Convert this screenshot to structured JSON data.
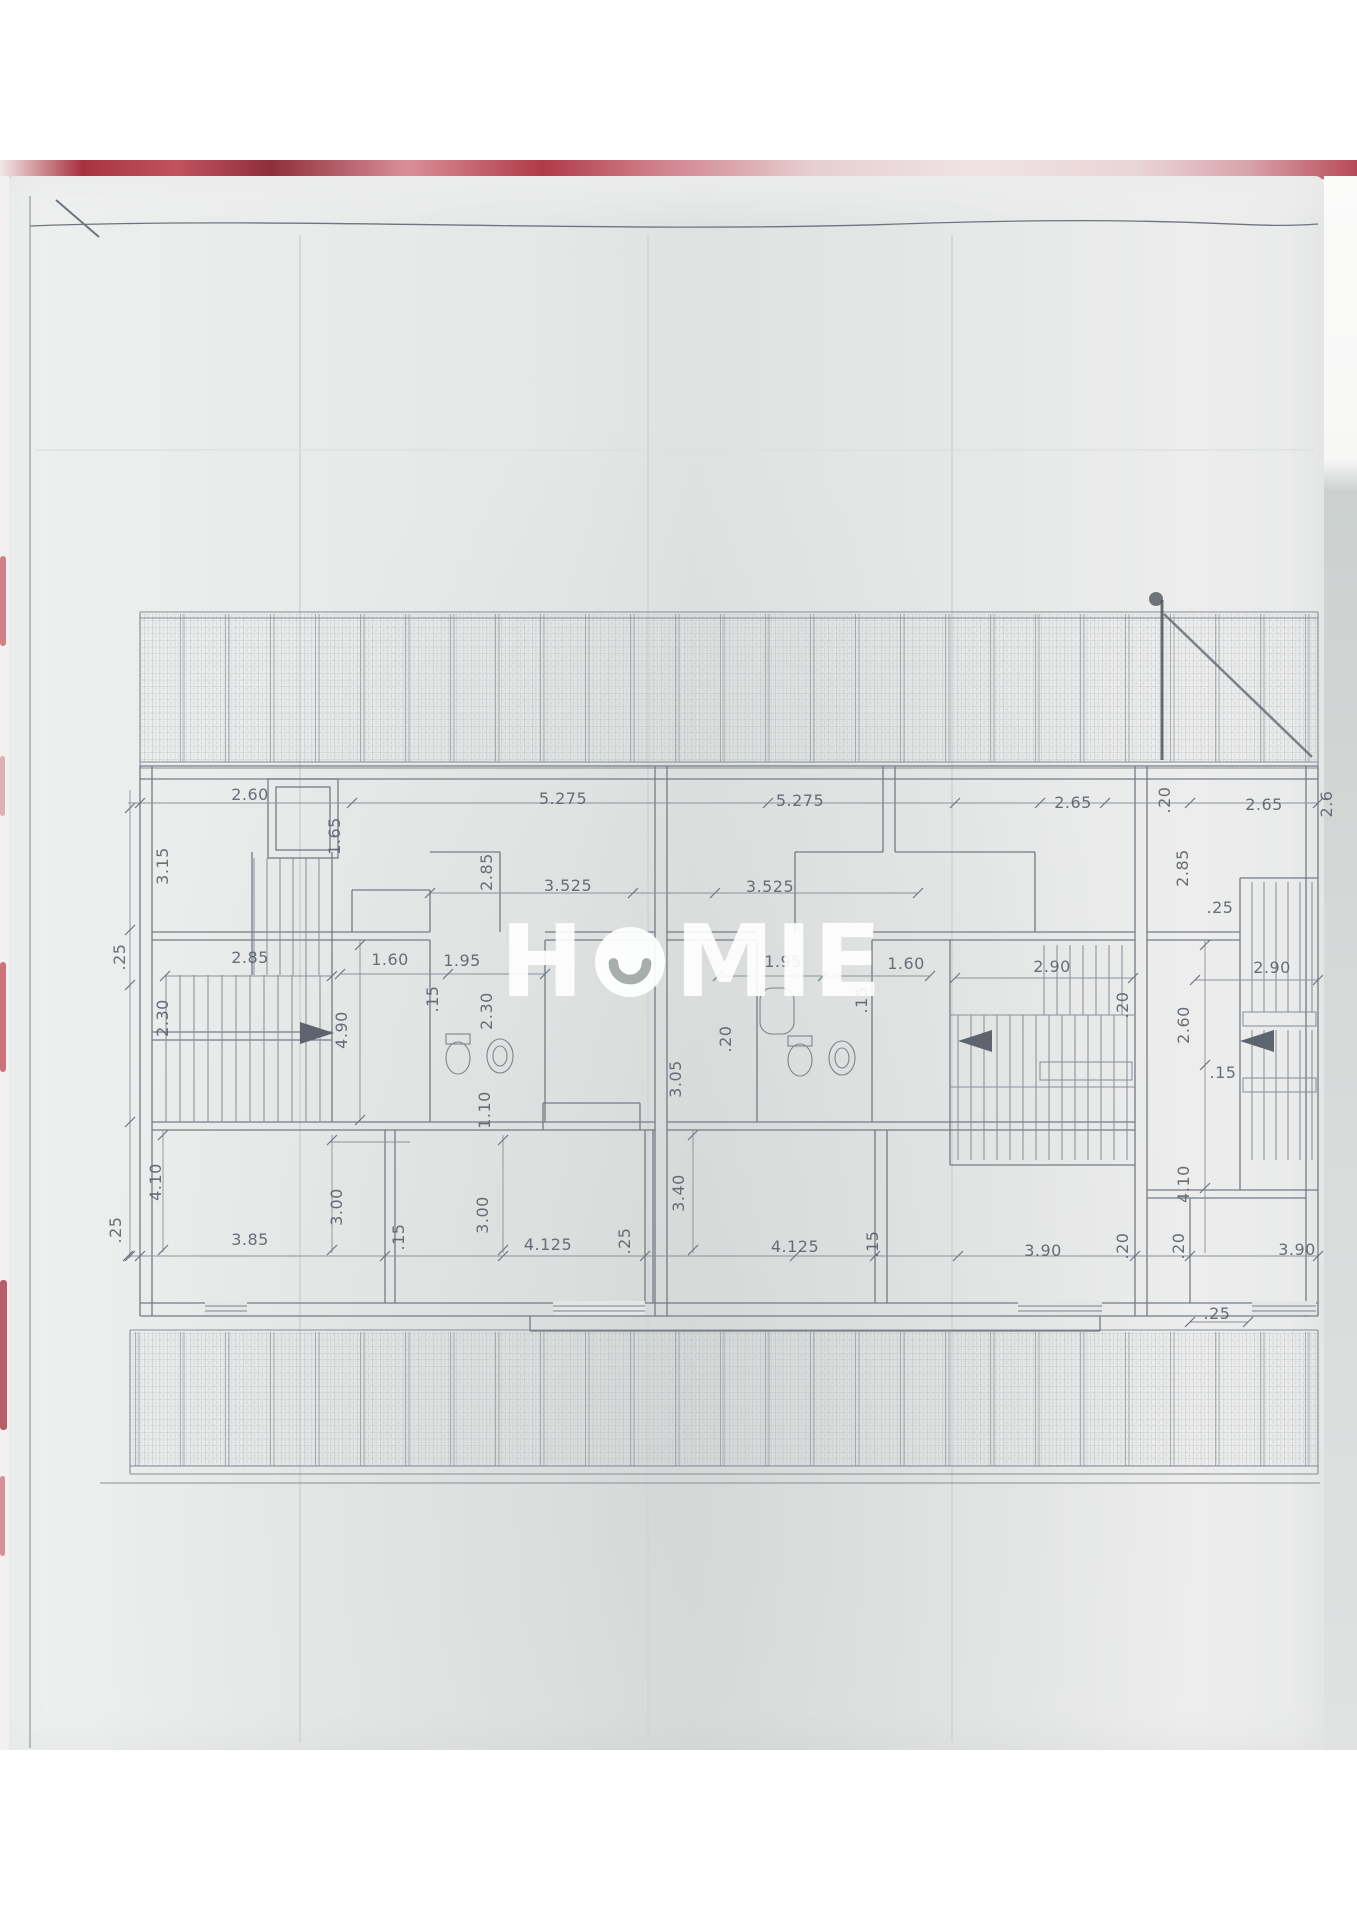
{
  "watermark": {
    "brand": "HOMIE",
    "part1": "H",
    "part2": "MIE",
    "circle_color": "#ffffff",
    "smile_color": "#99a09e"
  },
  "colors": {
    "fabric_red": "#b03a48",
    "paper_gray": "#e8eae9",
    "pencil_line": "#7a818b",
    "dimension_line": "#8b929b",
    "label_text": "#565d67"
  },
  "plan": {
    "drawing_kind": "floor plan with roof hatch bands",
    "dimension_labels": [
      {
        "t": "2.60",
        "x": 250,
        "y": 800,
        "r": 0
      },
      {
        "t": "5.275",
        "x": 563,
        "y": 804,
        "r": 0
      },
      {
        "t": "5.275",
        "x": 800,
        "y": 806,
        "r": 0
      },
      {
        "t": "2.65",
        "x": 1073,
        "y": 808,
        "r": 0
      },
      {
        "t": ".20",
        "x": 1170,
        "y": 800,
        "r": -90
      },
      {
        "t": "2.65",
        "x": 1264,
        "y": 810,
        "r": 0
      },
      {
        "t": "2.6",
        "x": 1332,
        "y": 804,
        "r": -90
      },
      {
        "t": "3.15",
        "x": 168,
        "y": 866,
        "r": -90
      },
      {
        "t": "1.65",
        "x": 340,
        "y": 836,
        "r": -90
      },
      {
        "t": "2.85",
        "x": 492,
        "y": 872,
        "r": -90
      },
      {
        "t": "3.525",
        "x": 568,
        "y": 891,
        "r": 0
      },
      {
        "t": "3.525",
        "x": 770,
        "y": 892,
        "r": 0
      },
      {
        "t": "2.85",
        "x": 1188,
        "y": 868,
        "r": -90
      },
      {
        "t": ".25",
        "x": 125,
        "y": 957,
        "r": -90
      },
      {
        "t": "2.85",
        "x": 250,
        "y": 963,
        "r": 0
      },
      {
        "t": "1.60",
        "x": 390,
        "y": 965,
        "r": 0
      },
      {
        "t": "1.95",
        "x": 462,
        "y": 966,
        "r": 0
      },
      {
        "t": ".15",
        "x": 438,
        "y": 999,
        "r": -90
      },
      {
        "t": "2.30",
        "x": 168,
        "y": 1018,
        "r": -90
      },
      {
        "t": "2.30",
        "x": 492,
        "y": 1011,
        "r": -90
      },
      {
        "t": "4.90",
        "x": 347,
        "y": 1030,
        "r": -90
      },
      {
        "t": "1.10",
        "x": 490,
        "y": 1110,
        "r": -90
      },
      {
        "t": "1.95",
        "x": 783,
        "y": 967,
        "r": 0
      },
      {
        "t": "1.60",
        "x": 906,
        "y": 969,
        "r": 0
      },
      {
        "t": ".15",
        "x": 867,
        "y": 1000,
        "r": -90
      },
      {
        "t": ".20",
        "x": 731,
        "y": 1039,
        "r": -90
      },
      {
        "t": "3.05",
        "x": 681,
        "y": 1079,
        "r": -90
      },
      {
        "t": "2.90",
        "x": 1052,
        "y": 972,
        "r": 0
      },
      {
        "t": ".20",
        "x": 1128,
        "y": 1005,
        "r": -90
      },
      {
        "t": "2.60",
        "x": 1189,
        "y": 1025,
        "r": -90
      },
      {
        "t": ".25",
        "x": 1220,
        "y": 913,
        "r": 0
      },
      {
        "t": "2.90",
        "x": 1272,
        "y": 973,
        "r": 0
      },
      {
        "t": ".15",
        "x": 1223,
        "y": 1078,
        "r": 0
      },
      {
        "t": ".25",
        "x": 121,
        "y": 1230,
        "r": -90
      },
      {
        "t": "4.10",
        "x": 161,
        "y": 1182,
        "r": -90
      },
      {
        "t": "3.85",
        "x": 250,
        "y": 1245,
        "r": 0
      },
      {
        "t": "3.00",
        "x": 342,
        "y": 1207,
        "r": -90
      },
      {
        "t": ".15",
        "x": 404,
        "y": 1237,
        "r": -90
      },
      {
        "t": "3.00",
        "x": 488,
        "y": 1215,
        "r": -90
      },
      {
        "t": "4.125",
        "x": 548,
        "y": 1250,
        "r": 0
      },
      {
        "t": ".25",
        "x": 630,
        "y": 1241,
        "r": -90
      },
      {
        "t": "3.40",
        "x": 684,
        "y": 1193,
        "r": -90
      },
      {
        "t": "4.125",
        "x": 795,
        "y": 1252,
        "r": 0
      },
      {
        "t": ".15",
        "x": 878,
        "y": 1244,
        "r": -90
      },
      {
        "t": "3.90",
        "x": 1043,
        "y": 1256,
        "r": 0
      },
      {
        "t": ".20",
        "x": 1128,
        "y": 1246,
        "r": -90
      },
      {
        "t": ".20",
        "x": 1184,
        "y": 1246,
        "r": -90
      },
      {
        "t": "4.10",
        "x": 1189,
        "y": 1184,
        "r": -90
      },
      {
        "t": "3.90",
        "x": 1297,
        "y": 1255,
        "r": 0
      },
      {
        "t": ".25",
        "x": 1217,
        "y": 1319,
        "r": 0
      }
    ]
  }
}
